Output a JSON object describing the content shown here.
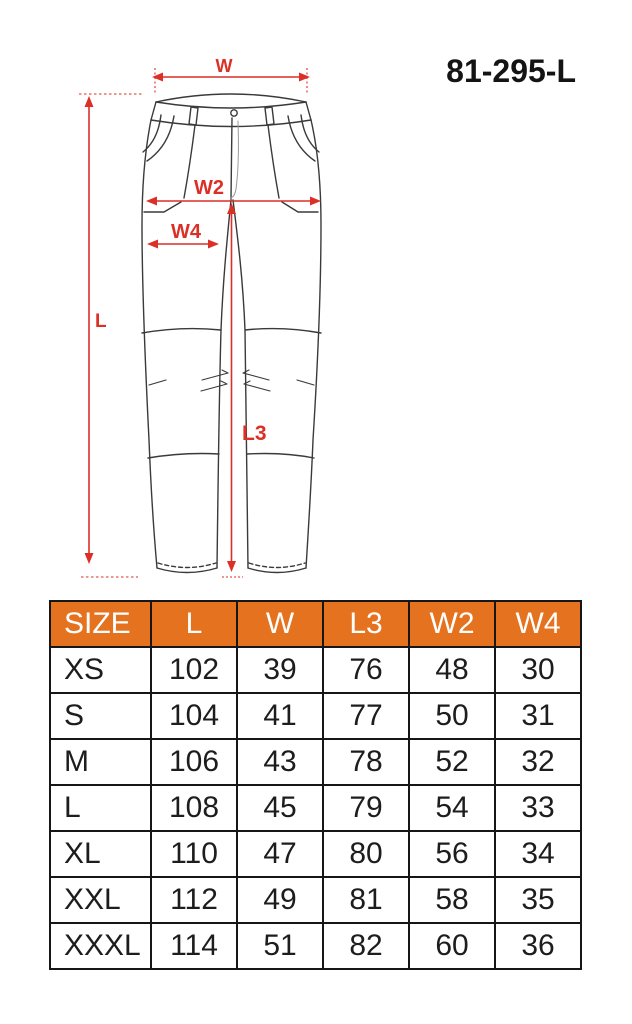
{
  "product_code": "81-295-L",
  "colors": {
    "header_orange": "#e5721f",
    "annotation_red": "#dc2f26",
    "table_border": "#161616",
    "drawing_line": "#3a3a3a"
  },
  "diagram": {
    "subject": "work-trousers-technical-drawing",
    "dimension_labels": {
      "w": "W",
      "w2": "W2",
      "w4": "W4",
      "l": "L",
      "l3": "L3"
    }
  },
  "size_table": {
    "columns": [
      "SIZE",
      "L",
      "W",
      "L3",
      "W2",
      "W4"
    ],
    "rows": [
      {
        "size": "XS",
        "values": [
          "102",
          "39",
          "76",
          "48",
          "30"
        ]
      },
      {
        "size": "S",
        "values": [
          "104",
          "41",
          "77",
          "50",
          "31"
        ]
      },
      {
        "size": "M",
        "values": [
          "106",
          "43",
          "78",
          "52",
          "32"
        ]
      },
      {
        "size": "L",
        "values": [
          "108",
          "45",
          "79",
          "54",
          "33"
        ]
      },
      {
        "size": "XL",
        "values": [
          "110",
          "47",
          "80",
          "56",
          "34"
        ]
      },
      {
        "size": "XXL",
        "values": [
          "112",
          "49",
          "81",
          "58",
          "35"
        ]
      },
      {
        "size": "XXXL",
        "values": [
          "114",
          "51",
          "82",
          "60",
          "36"
        ]
      }
    ]
  }
}
